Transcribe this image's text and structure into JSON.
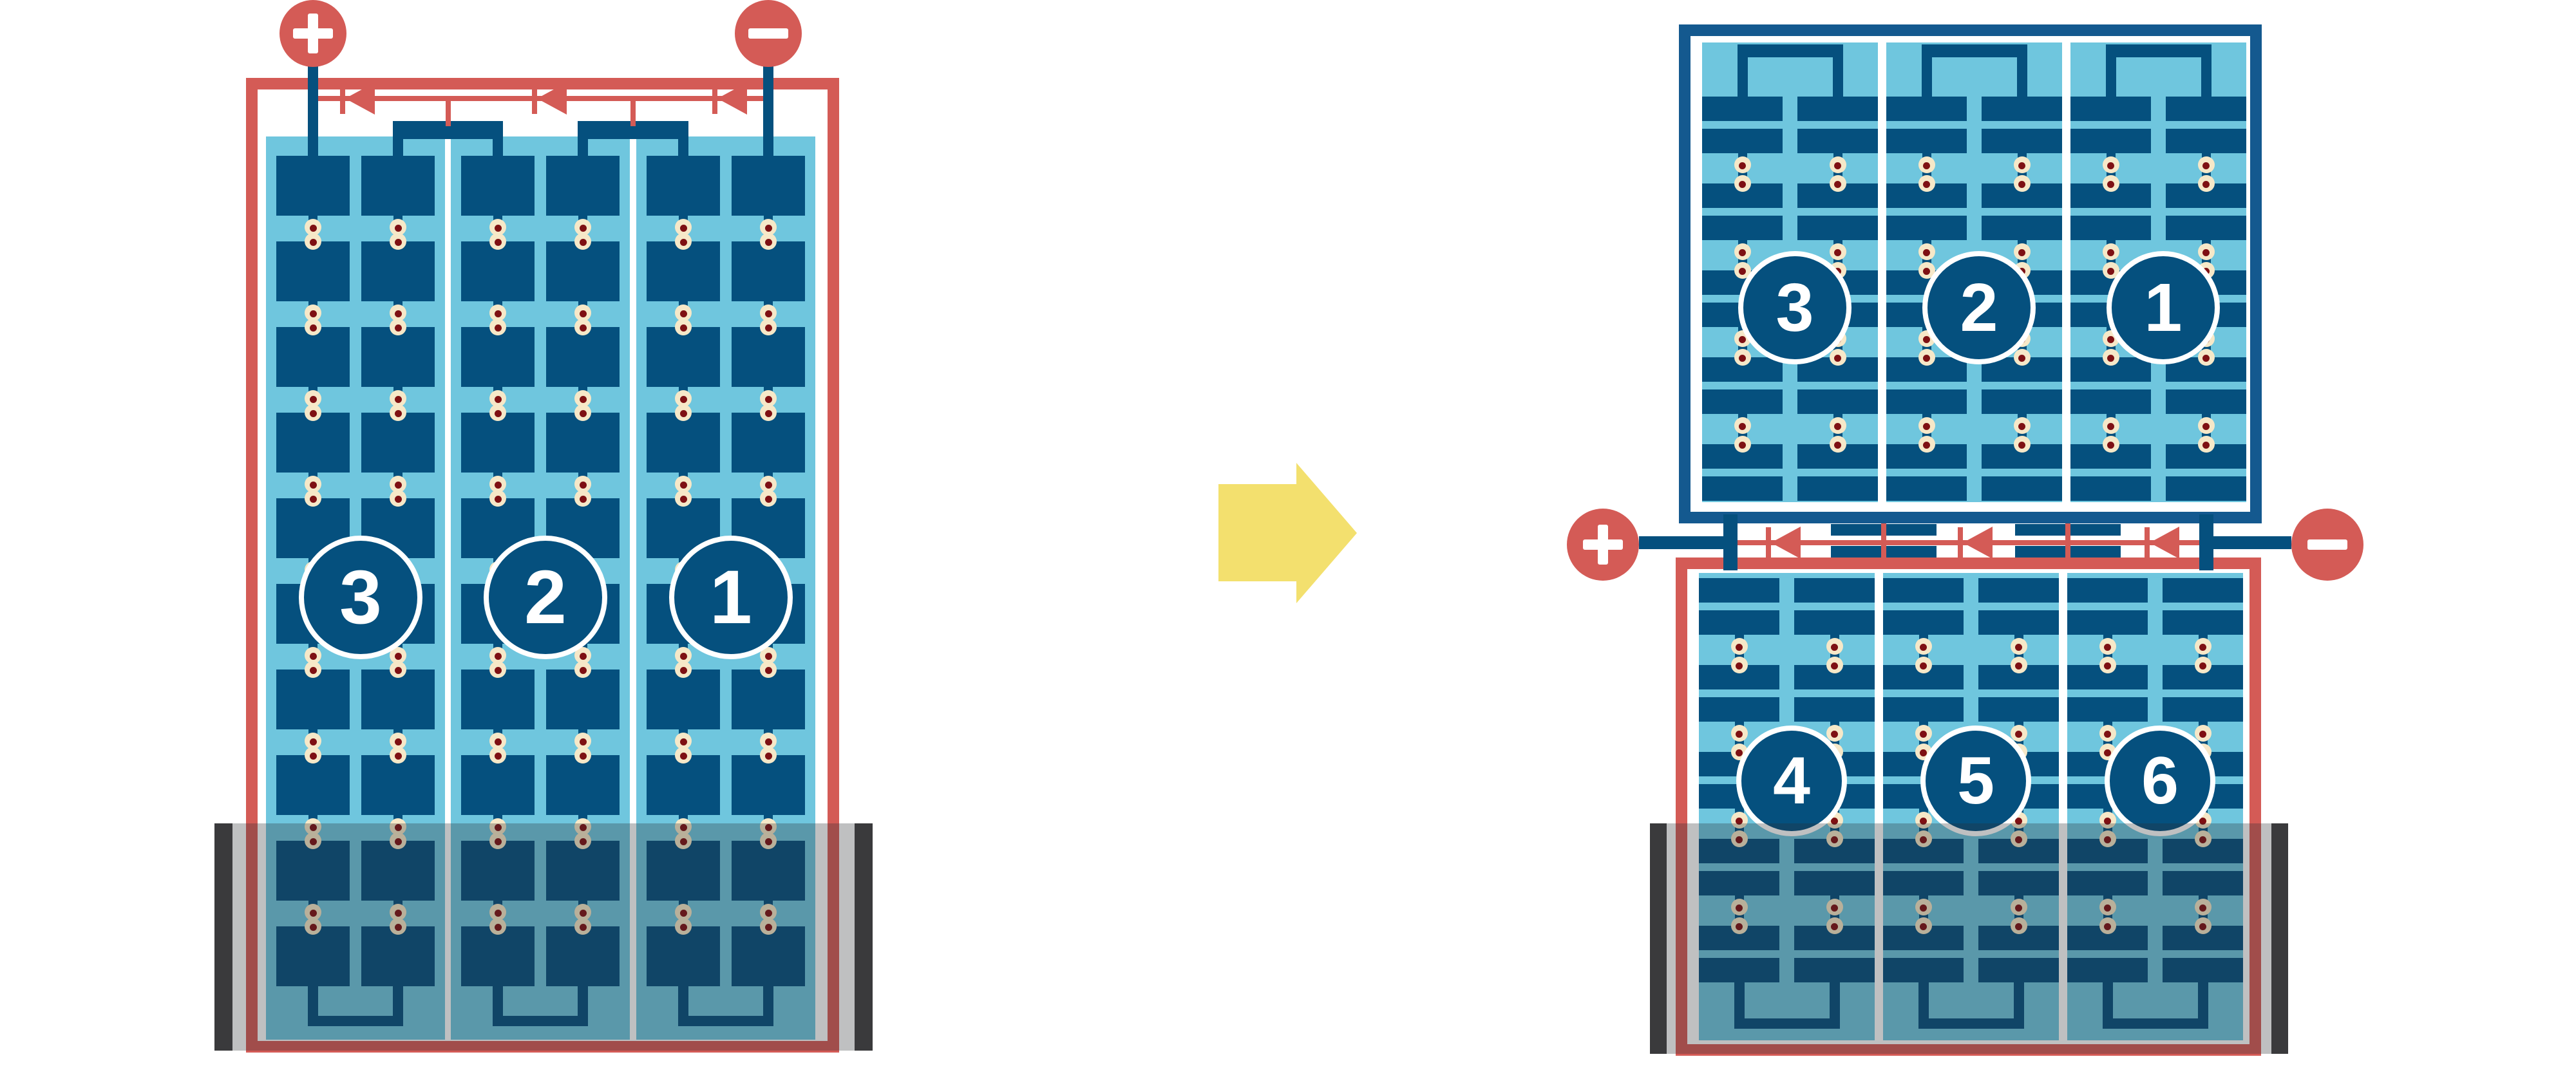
{
  "background": "#FFFFFF",
  "colors": {
    "red": "#D45B56",
    "panel_light_blue": "#6FC6DE",
    "cell_blue": "#05507E",
    "frame_blue": "#14598F",
    "solder_outer": "#F6E8C8",
    "solder_inner": "#7E1013",
    "arrow_yellow": "#F3E06E",
    "shade": "rgba(44,46,50,0.30)",
    "shade_cap": "#3A3A3C"
  },
  "left_module": {
    "description": "full-cell module, shaded along the bottom",
    "positive_terminal": {
      "symbol": "+"
    },
    "negative_terminal": {
      "symbol": "−"
    },
    "bypass_diode_count": 3,
    "string_count": 3,
    "string_labels": [
      "3",
      "2",
      "1"
    ],
    "cell_rows": 10,
    "cell_columns_per_string": 2,
    "shading": "bottom strip shaded"
  },
  "arrow": {
    "direction": "right"
  },
  "right_module": {
    "description": "half-cell module split in two halves with junction in the middle",
    "top_panel": {
      "frame_color": "blue",
      "string_count": 3,
      "string_labels": [
        "3",
        "2",
        "1"
      ],
      "cell_rows": 10,
      "cell_columns_per_string": 2
    },
    "junction": {
      "positive_terminal": {
        "symbol": "+"
      },
      "negative_terminal": {
        "symbol": "−"
      },
      "bypass_diode_count": 3
    },
    "bottom_panel": {
      "frame_color": "red",
      "string_count": 3,
      "string_labels": [
        "4",
        "5",
        "6"
      ],
      "cell_rows": 10,
      "cell_columns_per_string": 2,
      "shading": "bottom strip shaded"
    }
  }
}
